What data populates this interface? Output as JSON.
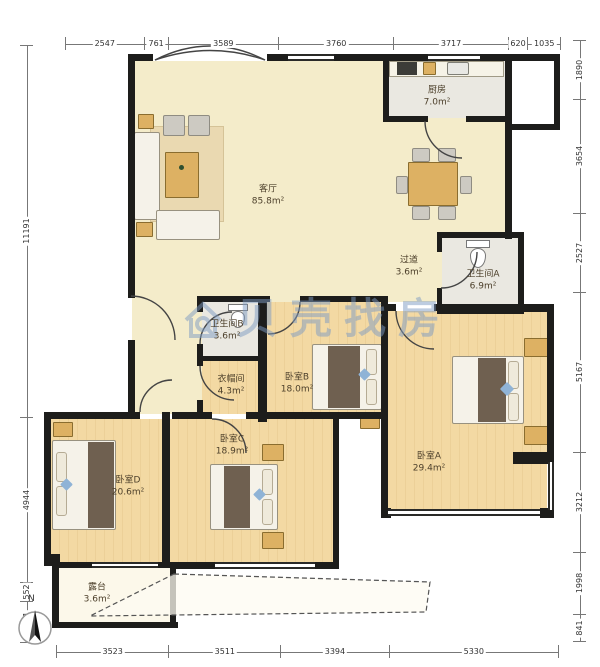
{
  "watermark": {
    "text": "贝壳找房",
    "logo": "house-magnifier"
  },
  "compass": {
    "north_label": "N"
  },
  "dimensions": {
    "top": [
      "2547",
      "761",
      "3589",
      "3760",
      "3717",
      "620",
      "1035"
    ],
    "bottom": [
      "3523",
      "3511",
      "3394",
      "5330"
    ],
    "left": [
      "11191",
      "4944",
      "552",
      "1201"
    ],
    "right": [
      "1890",
      "3654",
      "2527",
      "5167",
      "3212",
      "1998",
      "841"
    ]
  },
  "rooms": [
    {
      "id": "living-room",
      "name": "客厅",
      "area": "85.8m²"
    },
    {
      "id": "kitchen",
      "name": "厨房",
      "area": "7.0m²"
    },
    {
      "id": "hallway",
      "name": "过道",
      "area": "3.6m²"
    },
    {
      "id": "bathroom-a",
      "name": "卫生间A",
      "area": "6.9m²"
    },
    {
      "id": "bathroom-b",
      "name": "卫生间B",
      "area": "3.6m²"
    },
    {
      "id": "closet",
      "name": "衣帽间",
      "area": "4.3m²"
    },
    {
      "id": "bedroom-b",
      "name": "卧室B",
      "area": "18.0m²"
    },
    {
      "id": "bedroom-a",
      "name": "卧室A",
      "area": "29.4m²"
    },
    {
      "id": "bedroom-c",
      "name": "卧室C",
      "area": "18.9m²"
    },
    {
      "id": "bedroom-d",
      "name": "卧室D",
      "area": "20.6m²"
    },
    {
      "id": "terrace",
      "name": "露台",
      "area": "3.6m²"
    }
  ],
  "colors": {
    "wall": "#1d1d1b",
    "floor-living": "#f4ecca",
    "floor-wood": "#f2d8a2",
    "floor-tile": "#eae8e1",
    "watermark": "#7d9bc3",
    "accent": "#ddb163"
  }
}
